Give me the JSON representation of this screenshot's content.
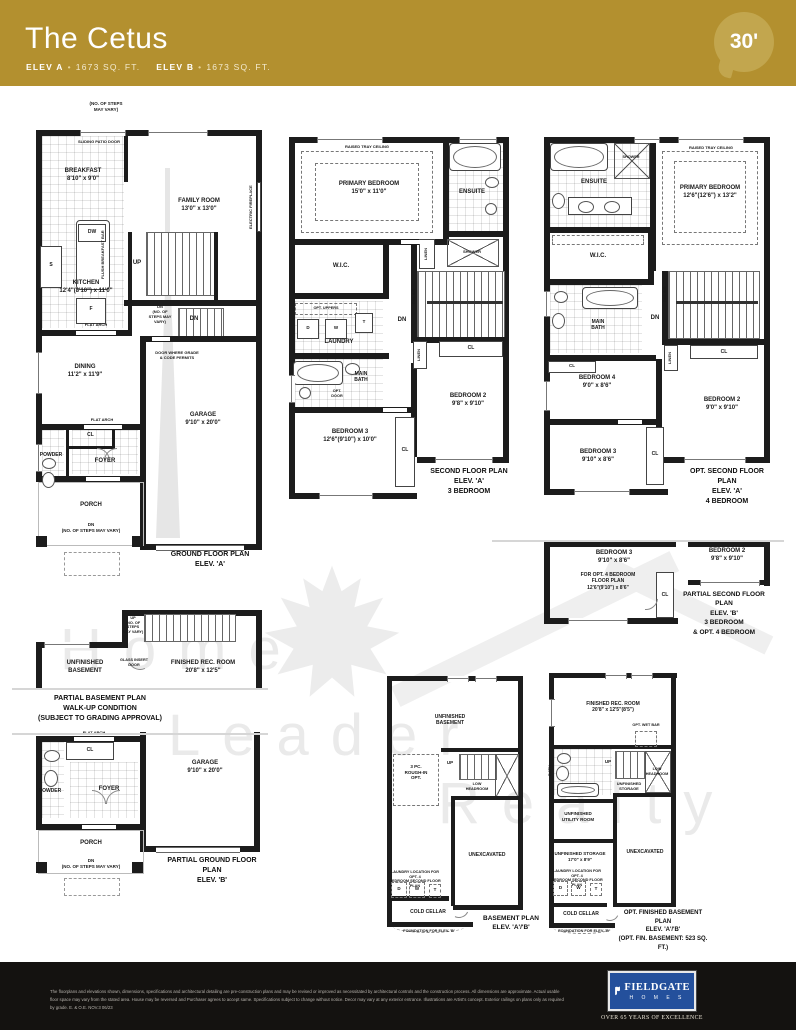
{
  "header": {
    "title": "The Cetus",
    "elev_a": "ELEV A",
    "elev_a_sqft": "1673 SQ. FT.",
    "elev_b": "ELEV B",
    "elev_b_sqft": "1673 SQ. FT.",
    "bullet": "•",
    "lot_badge": "30'"
  },
  "watermark": {
    "word1": "Home",
    "word2": "Leader",
    "word3": "Realty"
  },
  "plans": {
    "g1": {
      "caption": "GROUND FLOOR PLAN\nELEV. 'A'",
      "steps_top": "(NO. OF STEPS\nMAY VARY)",
      "patio": "SLIDING PATIO DOOR",
      "breakfast": "BREAKFAST\n8'10\" x 9'0\"",
      "family": "FAMILY ROOM\n13'0\" x 13'0\"",
      "fireplace": "ELECTRIC FIREPLACE",
      "dw": "DW",
      "bar": "FLUSH BREAKFAST BAR",
      "s": "S",
      "kitchen": "KITCHEN\n12'4\"(8'10\") x 11'0\"",
      "f": "F",
      "up": "UP",
      "dn_note": "DN\n(NO. OF\nSTEPS MAY\nVARY)",
      "dn": "DN",
      "flat_arch": "FLAT ARCH",
      "door_grade": "DOOR WHERE GRADE\n& CODE PERMITS",
      "dining": "DINING\n11'2\" x 11'9\"",
      "cl": "CL",
      "powder": "POWDER",
      "foyer": "FOYER",
      "garage": "GARAGE\n9'10\" x 20'0\"",
      "porch": "PORCH",
      "dn_porch": "DN\n(NO. OF STEPS MAY VARY)"
    },
    "s2": {
      "caption": "SECOND FLOOR PLAN\nELEV. 'A'\n3 BEDROOM",
      "tray": "RAISED TRAY CEILING",
      "primary": "PRIMARY BEDROOM\n15'0\" x 11'0\"",
      "ensuite": "ENSUITE",
      "shower": "SHOWER",
      "wic": "W.I.C.",
      "linen": "LINEN",
      "opt_uppers": "OPT. UPPERS",
      "d": "D",
      "w": "W",
      "t": "T",
      "laundry": "LAUNDRY",
      "railing": "RAILING",
      "dn": "DN",
      "cl": "CL",
      "main_bath": "MAIN\nBATH",
      "opt_door": "OPT.\nDOOR",
      "bed2": "BEDROOM 2\n9'8\" x 9'10\"",
      "bed3": "BEDROOM 3\n12'6\"(9'10\") x 10'0\""
    },
    "s2o": {
      "caption": "OPT. SECOND FLOOR PLAN\nELEV. 'A'\n4 BEDROOM",
      "tray": "RAISED TRAY CEILING",
      "primary": "PRIMARY BEDROOM\n12'6\"(12'6\") x 13'2\"",
      "ensuite": "ENSUITE",
      "shower": "SHOWER",
      "wic": "W.I.C.",
      "main_bath": "MAIN\nBATH",
      "linen": "LINEN",
      "railing": "RAILING",
      "dn": "DN",
      "cl": "CL",
      "bed4": "BEDROOM 4\n9'0\" x 8'6\"",
      "bed2": "BEDROOM 2\n9'0\" x 9'10\"",
      "bed3": "BEDROOM 3\n9'10\" x 8'6\""
    },
    "s2b": {
      "caption": "PARTIAL SECOND FLOOR PLAN\nELEV. 'B'\n3 BEDROOM\n& OPT. 4 BEDROOM",
      "bed3": "BEDROOM 3\n9'10\" x 8'6\"",
      "opt4": "FOR OPT. 4 BEDROOM\nFLOOR PLAN\n12'6\"(9'10\") x 8'6\"",
      "cl": "CL",
      "bed2": "BEDROOM 2\n9'8\" x 9'10\""
    },
    "bw": {
      "caption": "PARTIAL BASEMENT PLAN\nWALK-UP CONDITION\n(SUBJECT TO GRADING APPROVAL)",
      "up": "UP\n(NO. OF\nSTEPS\nMAY VARY)",
      "glass": "GLASS INSERT\nDOOR",
      "unf": "UNFINISHED\nBASEMENT",
      "rec": "FINISHED REC. ROOM\n20'8\" x 12'5\""
    },
    "g1b": {
      "caption": "PARTIAL GROUND FLOOR PLAN\nELEV. 'B'",
      "flat_arch": "FLAT ARCH",
      "cl": "CL",
      "powder": "POWDER",
      "foyer": "FOYER",
      "garage": "GARAGE\n9'10\" x 20'0\"",
      "porch": "PORCH",
      "dn_porch": "DN\n(NO. OF STEPS MAY VARY)"
    },
    "bsm": {
      "caption": "BASEMENT PLAN\nELEV. 'A'/'B'",
      "unf": "UNFINISHED\nBASEMENT",
      "rough": "3 PC.\nROUGH-IN\nOPT.",
      "up": "UP",
      "low": "LOW\nHEADROOM",
      "unex": "UNEXCAVATED",
      "laundry_note": "LAUNDRY LOCATION FOR OPT. 4\nBEDROOM SECOND FLOOR PLAN",
      "d": "D",
      "w": "W",
      "t": "T",
      "cold": "COLD CELLAR",
      "foundation": "FOUNDATION FOR ELEV. 'B'"
    },
    "bsmo": {
      "caption": "OPT. FINISHED BASEMENT PLAN\nELEV. 'A'/'B'\n(OPT. FIN. BASEMENT: 523 SQ. FT.)",
      "rec": "FINISHED REC. ROOM\n20'8\" x 12'5\"(8'5\")",
      "wet": "OPT. WET BAR",
      "up": "UP",
      "low": "LOW\nHEADROOM",
      "stor1": "UNFINISHED\nSTORAGE",
      "bath": "BATH",
      "utility": "UNFINISHED\nUTILITY ROOM",
      "stor2": "UNFINISHED STORAGE\n17'0\" x 8'9\"",
      "laundry_note": "LAUNDRY LOCATION FOR OPT. 4\nBEDROOM SECOND FLOOR PLAN",
      "d": "D",
      "w": "W",
      "t": "T",
      "unex": "UNEXCAVATED",
      "cold": "COLD CELLAR",
      "foundation": "FOUNDATION FOR ELEV. 'B'"
    }
  },
  "footer": {
    "disclaimer": "The floorplans and elevations shown, dimensions, specifications and architectural detailing are pre-construction plans and may be revised or improved as necessitated by architectural controls and the construction process. All dimensions are approximate. Actual usable\nfloor space may vary from the stated area. House may be reversed and Purchaser agrees to accept same. Specifications subject to change without notice. Decor may vary at any exterior entrance. Illustrations are Artist's concept. Exterior railings on plans only as required\nby grade. E. & O.E. NOV.3 06/23",
    "logo_name": "FIELDGATE",
    "logo_sub": "H O M E S",
    "tagline": "OVER 65 YEARS OF EXCELLENCE"
  }
}
